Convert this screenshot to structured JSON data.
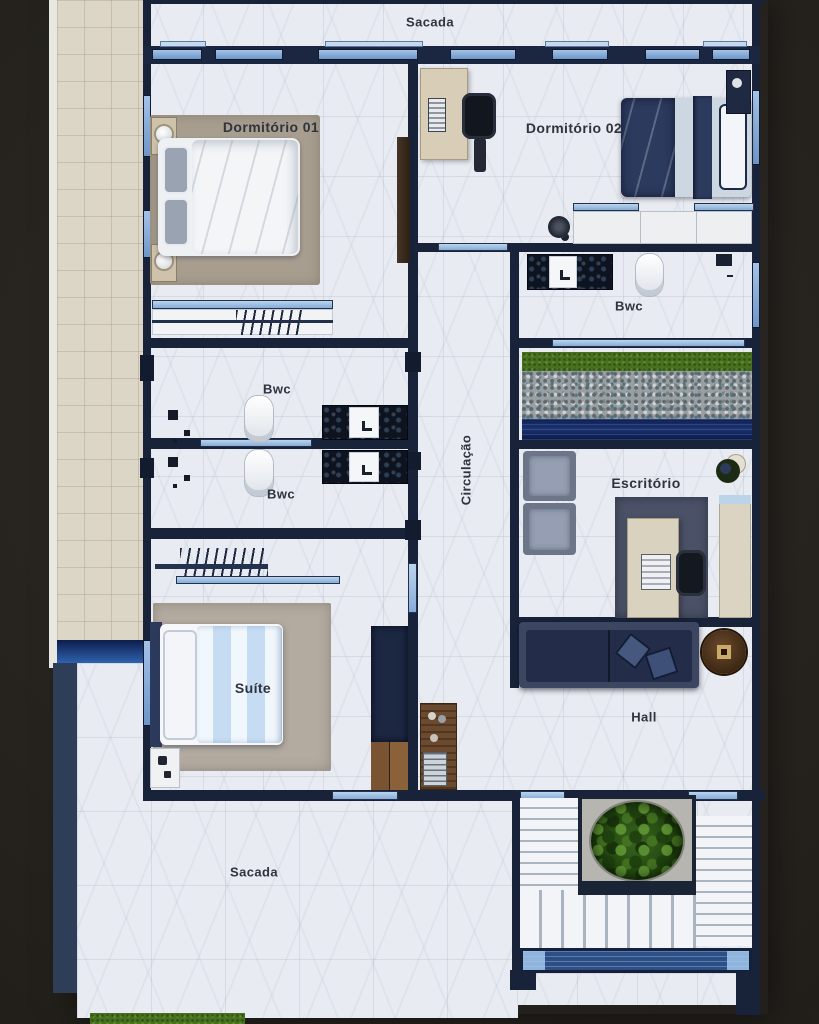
{
  "rooms": {
    "sacada_top": {
      "label": "Sacada"
    },
    "dormitorio_01": {
      "label": "Dormitório 01"
    },
    "dormitorio_02": {
      "label": "Dormitório 02"
    },
    "bwc_suite_right": {
      "label": "Bwc"
    },
    "bwc_upper": {
      "label": "Bwc"
    },
    "bwc_lower": {
      "label": "Bwc"
    },
    "circulacao": {
      "label": "Circulação"
    },
    "escritorio": {
      "label": "Escritório"
    },
    "suite": {
      "label": "Suíte"
    },
    "hall": {
      "label": "Hall"
    },
    "sacada_bottom": {
      "label": "Sacada"
    }
  },
  "colors": {
    "background": "#23201b",
    "wall": "#18233a",
    "marble_floor": "#e8ebf1",
    "exterior_tile": "#dcd6c7",
    "window_glass": "#85acd8",
    "navy_furniture": "#2b3a5c",
    "water": "#13265a",
    "grass": "#47711f",
    "gravel": "#99a0a3",
    "wood": "#6b4a2f"
  },
  "furniture": {
    "dormitorio_01": [
      "double-bed",
      "gray-pillows",
      "nightstand-with-lamp",
      "nightstand-with-lamp",
      "area-rug",
      "tv-panel",
      "closet-rack-with-hangers"
    ],
    "dormitorio_02": [
      "single-bed",
      "pillow",
      "desk",
      "laptop",
      "office-chair",
      "nightstand",
      "floor-fan",
      "sliding-wardrobe"
    ],
    "bwc_suite_right": [
      "stone-vanity",
      "sink",
      "toilet",
      "shower"
    ],
    "bwc_upper": [
      "toilet",
      "stone-vanity",
      "sink",
      "shower-head"
    ],
    "bwc_lower": [
      "toilet",
      "stone-vanity",
      "sink",
      "shower-head"
    ],
    "escritorio": [
      "armchair",
      "armchair",
      "desk",
      "laptop",
      "office-chair",
      "area-rug",
      "cabinet",
      "potted-plant"
    ],
    "suite": [
      "double-bed",
      "area-rug",
      "closet-rack-with-hangers",
      "nightstand",
      "wardrobe",
      "wood-drawers"
    ],
    "hall": [
      "sofa",
      "throw-pillows",
      "round-side-table",
      "wood-console"
    ],
    "garden_strip": [
      "grass-band",
      "pebble-bed",
      "water-feature"
    ],
    "stairs": [
      "u-shaped-staircase",
      "central-planter",
      "bush",
      "glass-railing"
    ],
    "exterior": [
      "side-walkway",
      "pool-strip",
      "lawn-patch"
    ]
  }
}
